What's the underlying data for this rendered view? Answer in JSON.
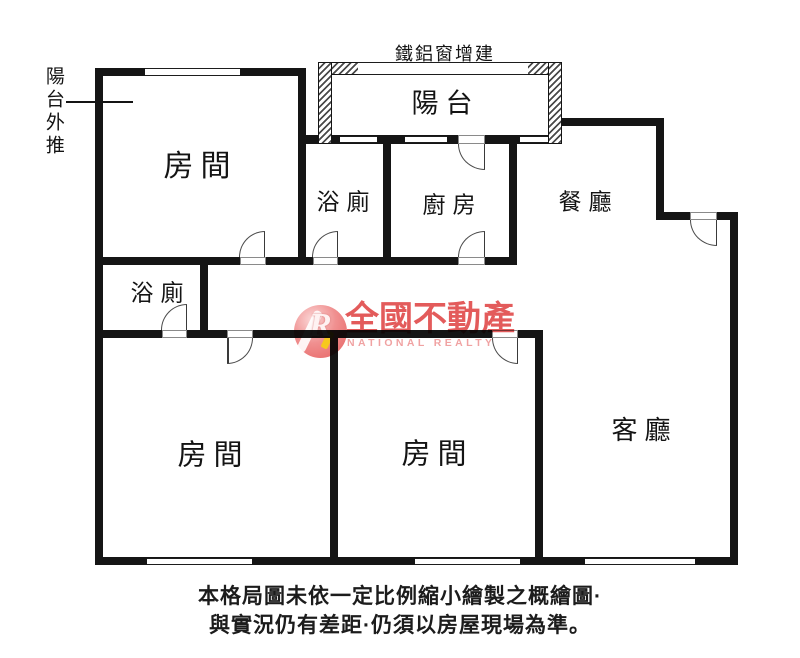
{
  "plan": {
    "rooms": [
      {
        "id": "bedroom-top-left",
        "label": "房間"
      },
      {
        "id": "balcony",
        "label": "陽台"
      },
      {
        "id": "bathroom-top",
        "label": "浴廁"
      },
      {
        "id": "kitchen",
        "label": "廚房"
      },
      {
        "id": "dining-room",
        "label": "餐廳"
      },
      {
        "id": "bathroom-middle",
        "label": "浴廁"
      },
      {
        "id": "bedroom-bottom-left",
        "label": "房間"
      },
      {
        "id": "bedroom-bottom-middle",
        "label": "房間"
      },
      {
        "id": "living-room",
        "label": "客廳"
      }
    ],
    "annotations": {
      "balcony_pushed_out": "陽台外推",
      "metal_window_addition": "鐵鋁窗增建"
    }
  },
  "watermark": {
    "logo_letter": "R",
    "brand_zh": "全國不動產",
    "brand_en": "NATIONAL REALTY",
    "colors": {
      "logo_circle": "#ee8080",
      "logo_accent": "#f7c81e",
      "brand_zh": "#de3e3e",
      "brand_en": "#f0a2a2"
    }
  },
  "caption": {
    "line1": "本格局圖未依一定比例縮小繪製之概繪圖·",
    "line2": "與實況仍有差距·仍須以房屋現場為準。"
  },
  "colors": {
    "wall": "#151515",
    "background": "#ffffff"
  }
}
